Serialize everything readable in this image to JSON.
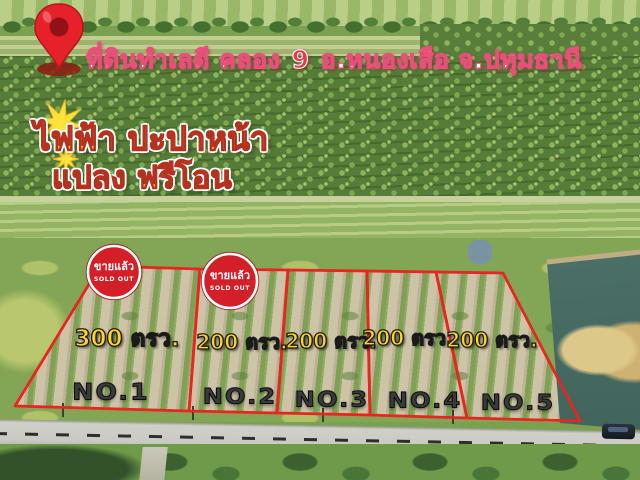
{
  "header": {
    "title_prefix": "ที่ดินทำเลดี คลอง",
    "title_number": "9",
    "title_suffix": "อ.หนองเสือ จ.ปทุมธานี"
  },
  "promo": {
    "line1": "ไฟฟ้า ปะปาหน้า",
    "line2": "แปลง ฟรีโอน"
  },
  "sold_badge": {
    "thai": "ขายแล้ว",
    "english": "SOLD OUT"
  },
  "plots": [
    {
      "number": "NO.1",
      "area": "300 ตรว.",
      "sold": true
    },
    {
      "number": "NO.2",
      "area": "200 ตรว.",
      "sold": true
    },
    {
      "number": "NO.3",
      "area": "200 ตรว.",
      "sold": false
    },
    {
      "number": "NO.4",
      "area": "200 ตรว.",
      "sold": false
    },
    {
      "number": "NO.5",
      "area": "200 ตรว.",
      "sold": false
    }
  ],
  "colors": {
    "plot_outline": "#e8251f",
    "badge_red": "#d41e28",
    "label_yellow": "#ffd225",
    "promo_yellow": "#ffc832",
    "promo_stroke": "#b5321f",
    "title_outline": "#e8507a",
    "title_number_red": "#e83848",
    "pin_red": "#e62129",
    "star_yellow": "#ffe23a"
  }
}
